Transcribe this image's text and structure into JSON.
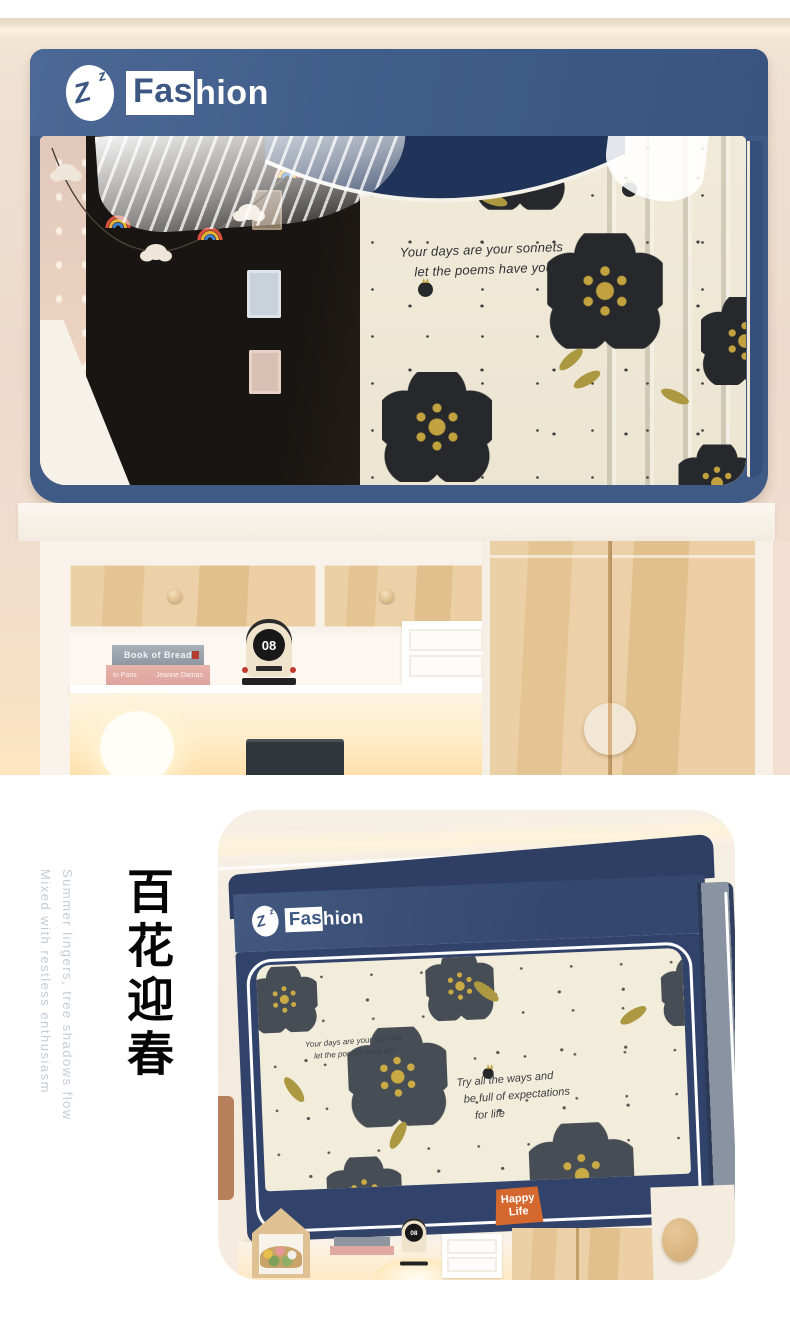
{
  "brand": {
    "logo_z_big": "Z",
    "logo_z_small": "z",
    "wordmark_highlight": "Fas",
    "wordmark_rest": "hion"
  },
  "top_photo": {
    "curtain_quote_line1": "Your days are your sonnets",
    "curtain_quote_line2": "let the poems have you",
    "clock_value": "08",
    "book_top_title": "Book of Bread",
    "book_bottom_title": "In Paris",
    "book_bottom_author": "Jeanne Damas"
  },
  "bottom_section": {
    "headline_cn": "百花迎春",
    "tagline_line1": "Summer lingers, tree shadows flow",
    "tagline_line2": "Mixed with restless enthusiasm",
    "card": {
      "panel_quote_line1": "Your days are your sonnets",
      "panel_quote_line2": "let the poems have you",
      "panel_motto_line1": "Try all the ways and",
      "panel_motto_line2": "be full of expectations",
      "panel_motto_line3": "for life",
      "badge_line1": "Happy",
      "badge_line2": "Life",
      "clock_value": "08"
    }
  },
  "colors": {
    "canopy_navy": "#3e5a85",
    "canopy_dark_navy": "#31436b",
    "curtain_cream": "#efe9d7",
    "flower_petal_dark": "#26282b",
    "flower_petal_gray": "#474d54",
    "flower_center_gold": "#c2a23f",
    "wood": "#e8c89b",
    "wall_pink": "#eedbcd",
    "badge_orange": "#d4682e",
    "tagline_gray_blue": "#c3cdd6",
    "warm_light": "#ffe3ae"
  }
}
